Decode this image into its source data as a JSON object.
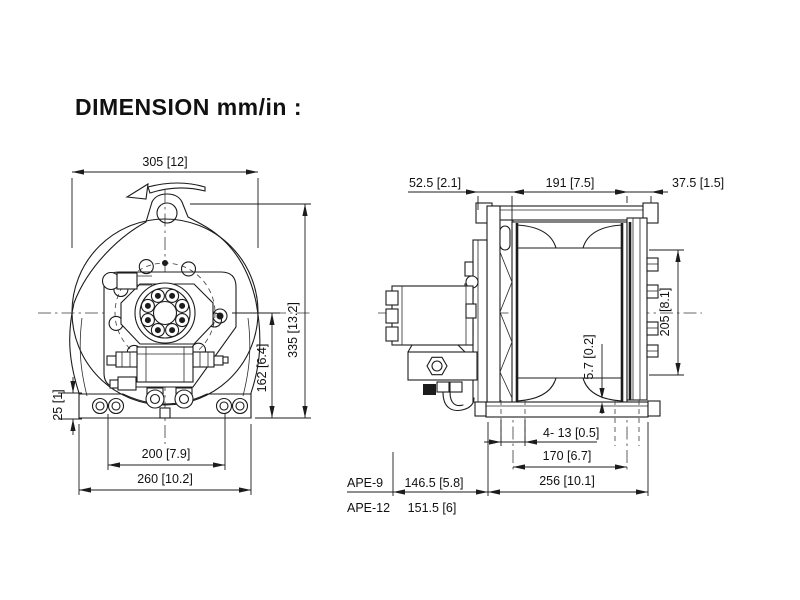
{
  "title": "DIMENSION mm/in :",
  "front_view": {
    "dims": {
      "overall_width": "305 [12]",
      "overall_height": "335 [13.2]",
      "motor_center_height": "162 [6.4]",
      "foot_height": "25 [1]",
      "bolt_spacing_width": "200 [7.9]",
      "base_width": "260 [10.2]"
    }
  },
  "side_view": {
    "dims": {
      "motor_offset": "52.5 [2.1]",
      "drum_length": "191 [7.5]",
      "right_offset": "37.5 [1.5]",
      "drum_diameter": "205 [8.1]",
      "base_gap": "5.7 [0.2]",
      "mounting_holes": "4- 13 [0.5]",
      "hole_spacing": "170 [6.7]",
      "base_length": "256 [10.1]"
    }
  },
  "model_table": {
    "rows": [
      {
        "model": "APE-9",
        "value": "146.5 [5.8]"
      },
      {
        "model": "APE-12",
        "value": "151.5 [6]"
      }
    ]
  }
}
